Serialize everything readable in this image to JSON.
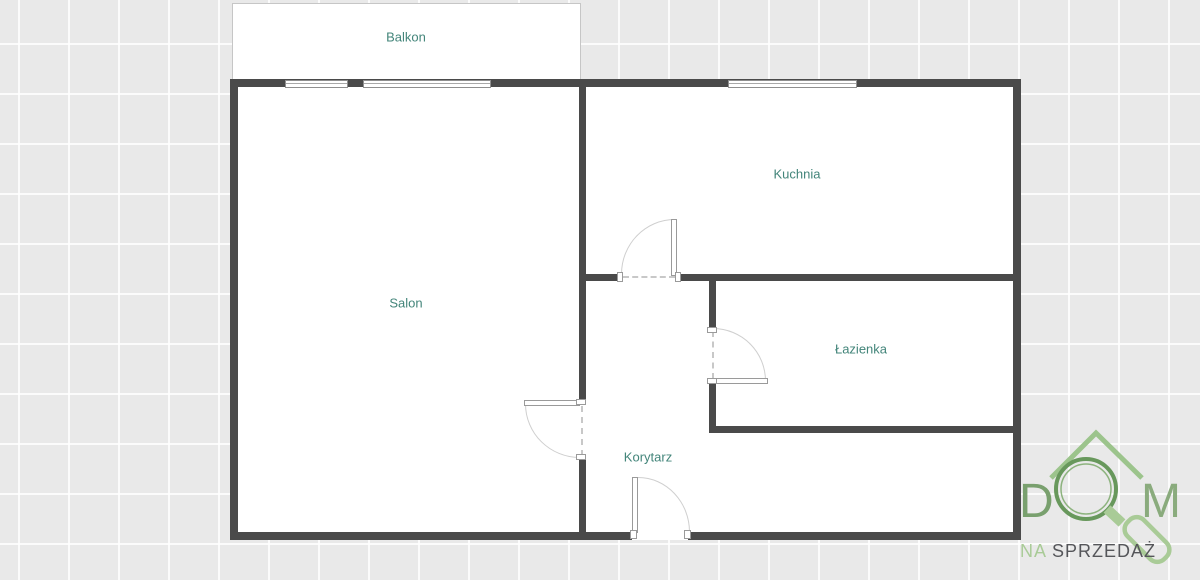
{
  "page": {
    "background_color": "#e9e9e9",
    "grid_line_color": "#ffffff",
    "grid_size_px": 50
  },
  "floorplan": {
    "wall_color": "#4a4a4a",
    "room_label_color": "#43857a",
    "rooms": [
      {
        "name": "balkon",
        "label": "Balkon"
      },
      {
        "name": "salon",
        "label": "Salon"
      },
      {
        "name": "kuchnia",
        "label": "Kuchnia"
      },
      {
        "name": "lazienka",
        "label": "Łazienka"
      },
      {
        "name": "korytarz",
        "label": "Korytarz"
      }
    ],
    "window_count": 3,
    "door_count": 4
  },
  "logo": {
    "letter_d": "D",
    "letter_m": "M",
    "tagline_na": "NA",
    "tagline_sprzedaz": "SPRZEDAŻ",
    "colors": {
      "roof": "#9cc48c",
      "letter_d": "#79a06e",
      "letter_m": "#8aab7d",
      "magnifier_ring": "#68985c",
      "magnifier_handle": "#a9cb97",
      "tagline_na": "#a9cb97",
      "tagline_text": "#55565a"
    }
  }
}
